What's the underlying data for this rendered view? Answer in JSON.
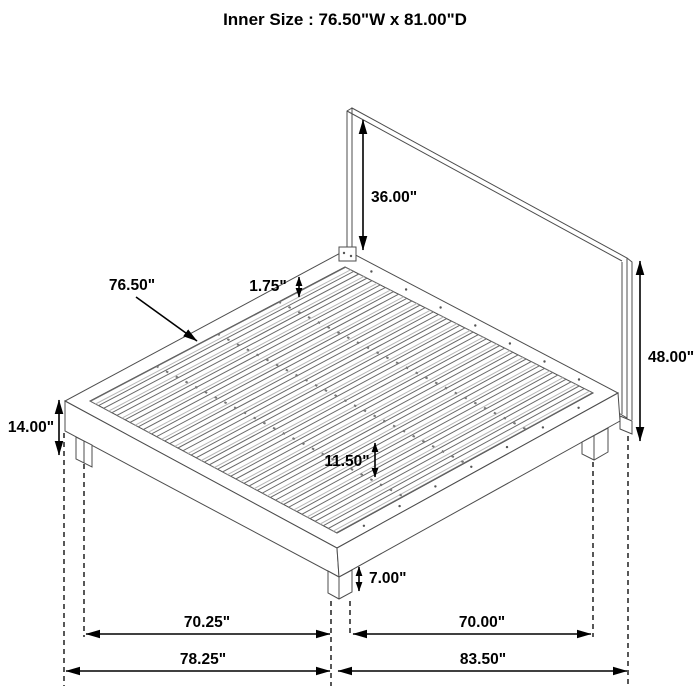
{
  "title": "Inner Size : 76.50\"W x 81.00\"D",
  "annotations": {
    "headboard_panel_height": "36.00\"",
    "slat_length": "76.50\"",
    "slat_spacing": "1.75\"",
    "overall_height": "48.00\"",
    "platform_top_height": "14.00\"",
    "under_bed_clearance": "11.50\"",
    "leg_height": "7.00\"",
    "leg_span_width": "70.25\"",
    "leg_span_depth": "70.00\"",
    "overall_width": "78.25\"",
    "overall_depth": "83.50\""
  },
  "figure": {
    "type": "isometric-line-drawing",
    "subject": "platform-bed-with-headboard",
    "slat_count": 19,
    "support_rail_count": 3,
    "line_color": "#4d4d4d",
    "dimension_color": "#000000",
    "background_color": "#ffffff"
  }
}
